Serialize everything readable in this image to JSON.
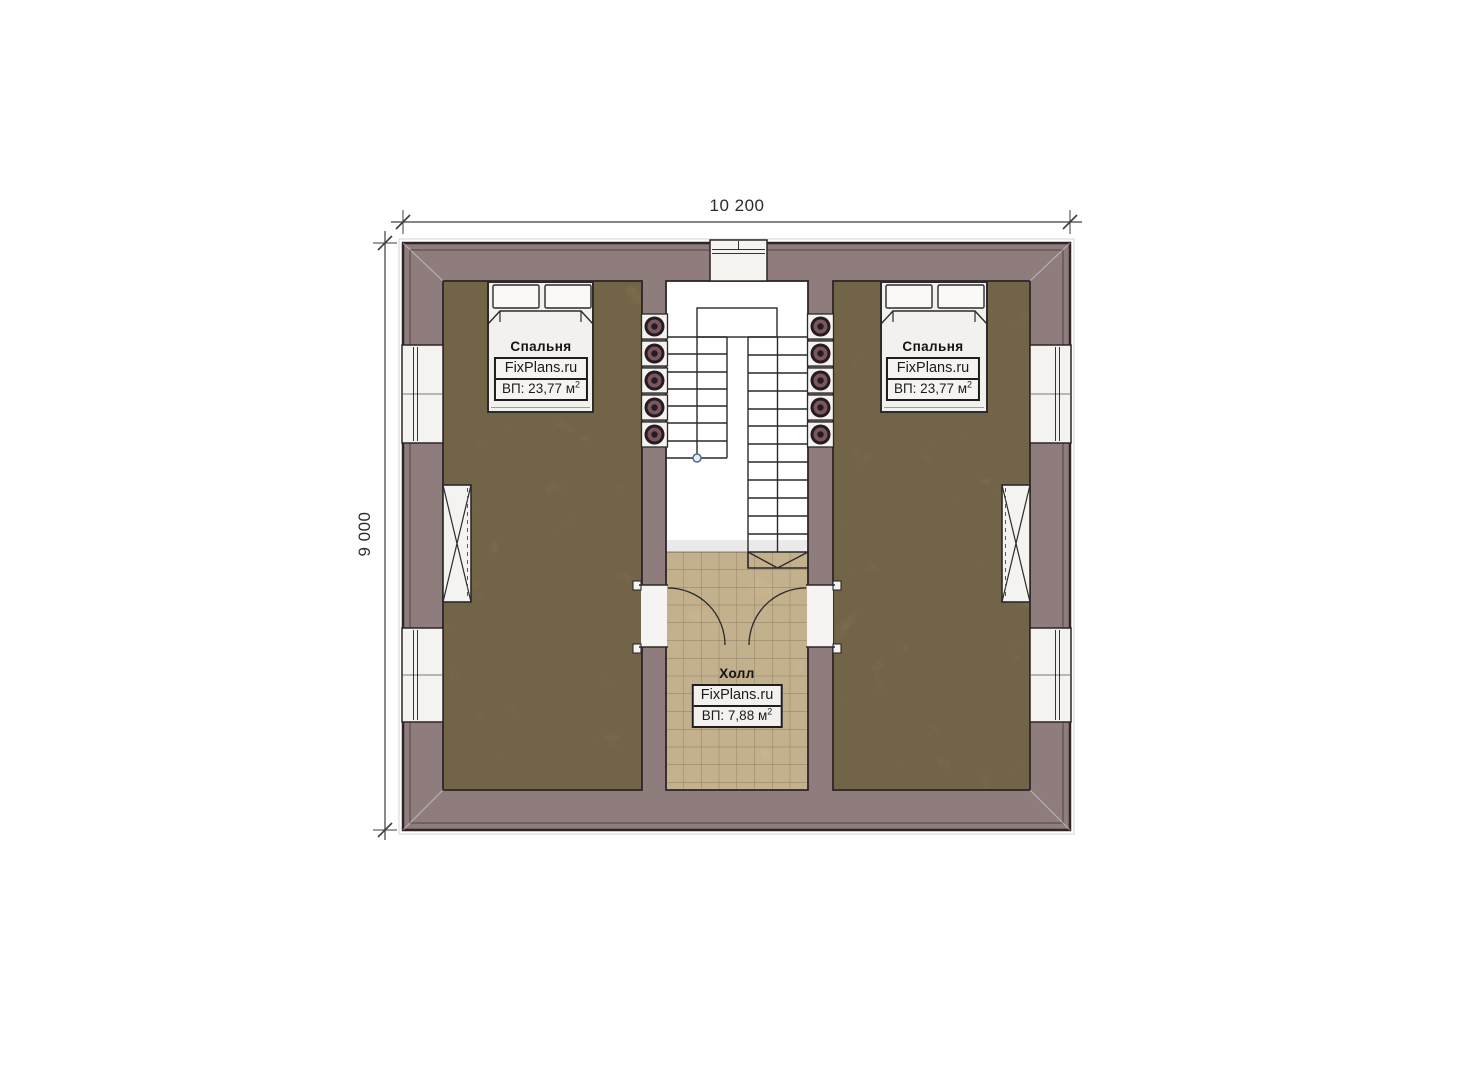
{
  "dimensions": {
    "width": "10 200",
    "height": "9 000"
  },
  "rooms": {
    "bedroom_left": {
      "name": "Спальня",
      "brand": "FixPlans.ru",
      "area_label": "ВП: 23,77 м",
      "area_sup": "2"
    },
    "bedroom_right": {
      "name": "Спальня",
      "brand": "FixPlans.ru",
      "area_label": "ВП: 23,77 м",
      "area_sup": "2"
    },
    "hall": {
      "name": "Холл",
      "brand": "FixPlans.ru",
      "area_label": "ВП: 7,88 м",
      "area_sup": "2"
    }
  },
  "colors": {
    "wall_fill": "#8f7c7c",
    "outline": "#2e2528",
    "bedroom_floor": "#8c7b58",
    "hall_tile": "#d5c09a",
    "tile_grid": "#7d6c50",
    "fixture_fill": "#f4f3f0",
    "stair_line": "#2a2a2a",
    "baluster_ring": "#7b565f",
    "baluster_dark": "#241c20",
    "dimension_line": "#3c3c3c",
    "label_text": "#1c1c1c"
  }
}
